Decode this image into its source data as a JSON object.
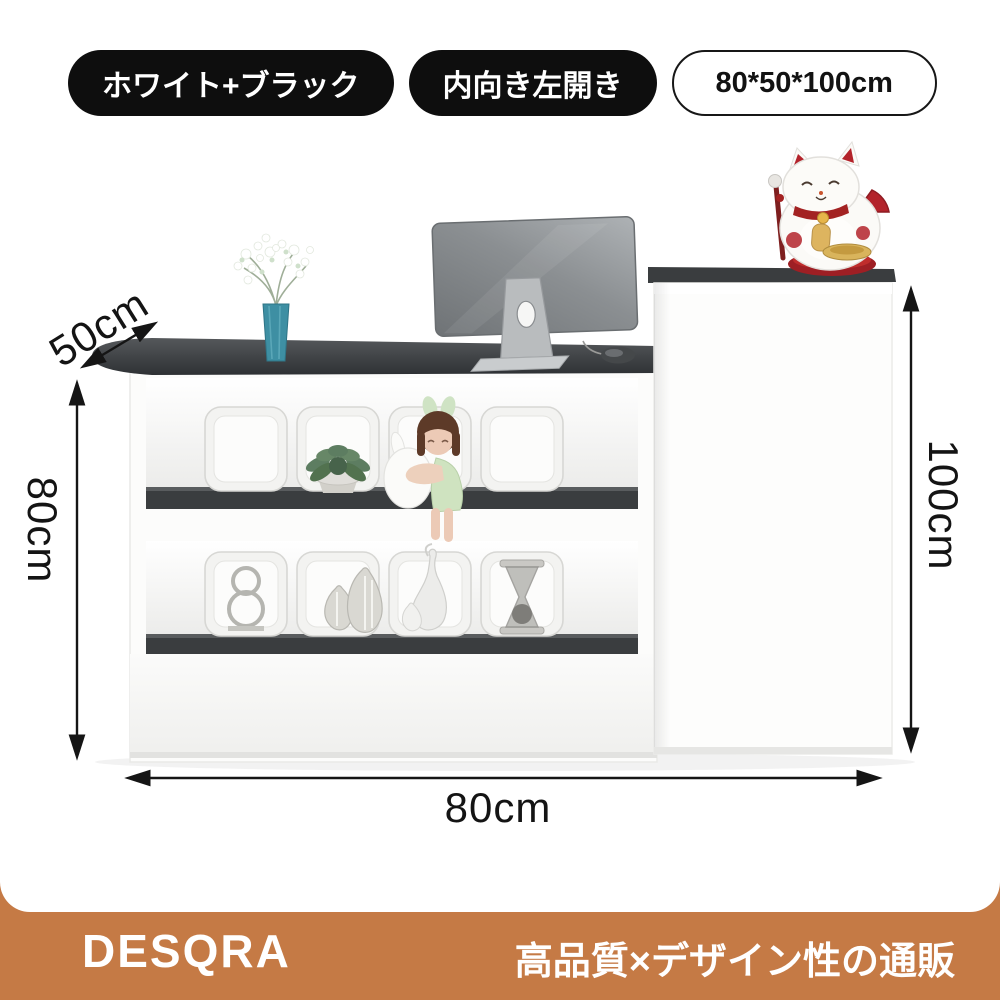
{
  "badges": [
    {
      "label": "ホワイト+ブラック",
      "variant": "dark"
    },
    {
      "label": "内向き左開き",
      "variant": "dark"
    },
    {
      "label": "80*50*100cm",
      "variant": "outline"
    }
  ],
  "dimensions": {
    "depth": "50cm",
    "height": "80cm",
    "total_height": "100cm",
    "width": "80cm"
  },
  "footer": {
    "brand": "DESQRA",
    "tagline": "高品質×デザイン性の通販"
  },
  "colors": {
    "badge_dark": "#0e0e0e",
    "accent_bar": "#c57a45",
    "counter_top_gray": "#3c3f42",
    "furniture_white": "#fcfcfb",
    "shelf_board_dark": "#3a3d3f",
    "vase_teal": "#3e8fa3",
    "lucky_cat_red": "#b3232b",
    "monitor_gray": "#86898c",
    "arrow_black": "#151515"
  },
  "photo_objects": [
    {
      "name": "reception-counter"
    },
    {
      "name": "side-cabinet"
    },
    {
      "name": "monitor"
    },
    {
      "name": "computer-mouse"
    },
    {
      "name": "flower-vase"
    },
    {
      "name": "succulent-plant"
    },
    {
      "name": "doll-with-rabbit"
    },
    {
      "name": "wire-sculpture"
    },
    {
      "name": "striped-vases"
    },
    {
      "name": "cat-tail-vase"
    },
    {
      "name": "hourglass"
    },
    {
      "name": "lucky-cat-figurine"
    }
  ]
}
